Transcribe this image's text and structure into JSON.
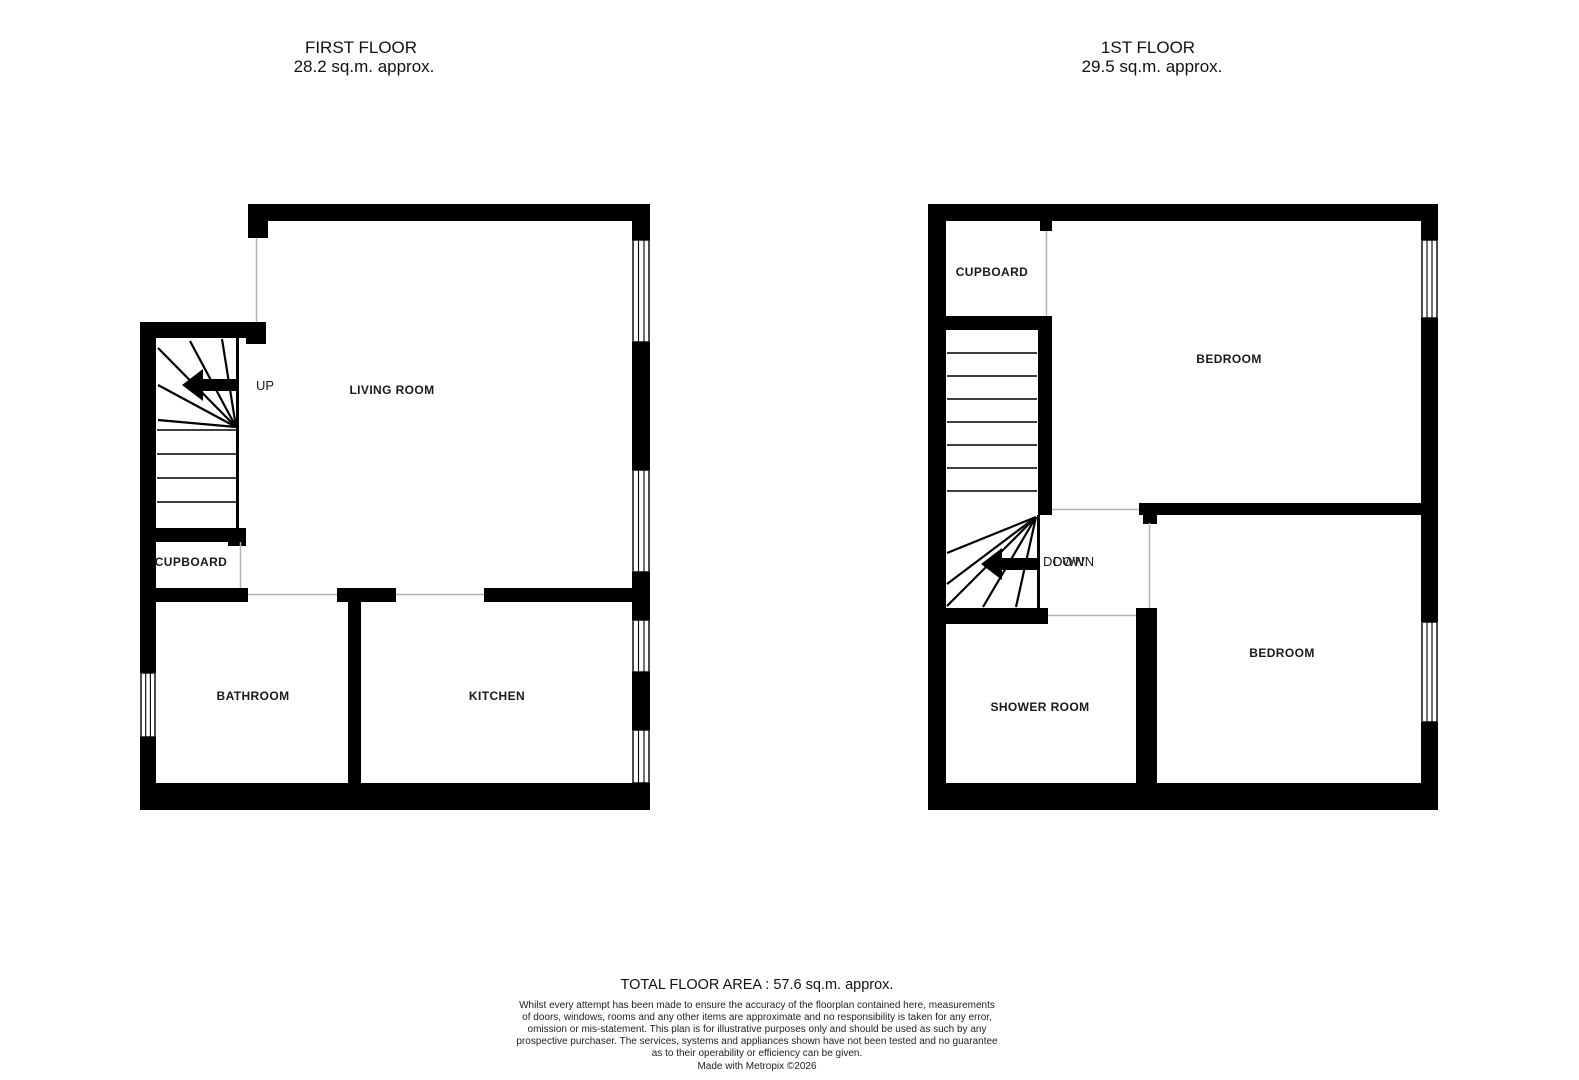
{
  "colors": {
    "wall": "#000000",
    "thin_line": "#b4b4b4",
    "background": "#ffffff",
    "text": "#1a1a1a"
  },
  "floor1": {
    "title": "FIRST FLOOR",
    "area_label": "28.2 sq.m. approx.",
    "rooms": {
      "living_room": "LIVING ROOM",
      "cupboard": "CUPBOARD",
      "bathroom": "BATHROOM",
      "kitchen": "KITCHEN"
    },
    "stairs": {
      "direction_label": "UP"
    }
  },
  "floor2": {
    "title": "1ST FLOOR",
    "area_label": "29.5 sq.m. approx.",
    "rooms": {
      "cupboard": "CUPBOARD",
      "bedroom_front": "BEDROOM",
      "bedroom_back": "BEDROOM",
      "shower_room": "SHOWER ROOM"
    },
    "stairs": {
      "direction_label": "DOWN",
      "direction_label_ghost": "DOWN"
    }
  },
  "footer": {
    "total_area": "TOTAL FLOOR AREA : 57.6 sq.m. approx.",
    "disclaimer": [
      "Whilst every attempt has been made to ensure the accuracy of the floorplan contained here, measurements",
      "of doors, windows, rooms and any other items are approximate and no responsibility is taken for any error,",
      "omission or mis-statement. This plan is for illustrative purposes only and should be used as such by any",
      "prospective purchaser. The services, systems and appliances shown have not been tested and no guarantee",
      "as to their operability or efficiency can be given."
    ],
    "credit": "Made with Metropix ©2026"
  }
}
